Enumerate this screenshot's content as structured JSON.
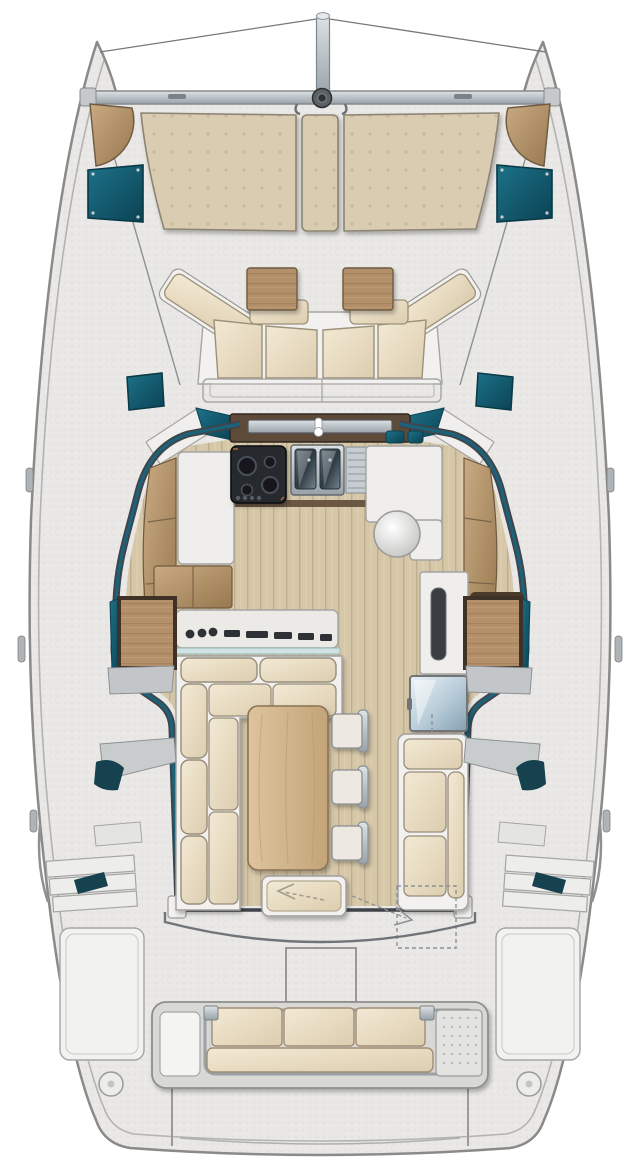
{
  "image": {
    "kind": "catamaran-deck-and-saloon-floor-plan",
    "view": "top-down",
    "visible_text": "none"
  },
  "palette": {
    "page_bg": "#ffffff",
    "deck_base": "#e9e8e6",
    "hull_outline": "#8a8a88",
    "gunwale_line": "#b3b3b1",
    "white_panel": "#f2f1ef",
    "panel_line": "#a5a5a3",
    "teal_glass": "#19647c",
    "teal_dark": "#0c4253",
    "wall_dark": "#40454b",
    "wood_mid": "#b08e66",
    "wood_frame": "#4a3a2a",
    "plank_base": "#d6c7a9",
    "table_wood": "#d2b68c",
    "cushion_cream": "#ecdfc6",
    "cushion_line": "#9c9179",
    "sunpad_beige": "#d9ccb1",
    "stove_black": "#26292e",
    "steel": "#aeb9c0",
    "fridge_steel": "#a9bfcd",
    "fitting_gray": "#b4b7ba",
    "dash_gray": "#8e9296",
    "glass_ledge": "#cfe3e2"
  },
  "components": {
    "rigging": [
      "bowsprit-pole",
      "forestay-wires",
      "forward-crossbeam",
      "beam-center-fitting"
    ],
    "foredeck": [
      "bow-step-pad-port",
      "bow-step-pad-starboard",
      "trampoline-port",
      "trampoline-starboard",
      "sunpad-port",
      "sunpad-center",
      "sunpad-starboard",
      "deck-plate-port",
      "deck-plate-starboard"
    ],
    "forward_cockpit": [
      "lounge-backrest-port",
      "lounge-backrest-starboard",
      "seat-cushions",
      "cocktail-table-port",
      "cocktail-table-starboard",
      "step-locker"
    ],
    "galley": [
      "sliding-window-track",
      "faucet",
      "stove-two-burner",
      "double-sink",
      "drainboard",
      "counter-port",
      "counter-starboard",
      "round-basin",
      "teal-canisters",
      "tall-cabinet-with-slot",
      "framed-locker",
      "shelf-bands"
    ],
    "nav_station": [
      "chart-desk",
      "instrument-knobs",
      "instrument-slots",
      "glass-ledge"
    ],
    "saloon": [
      "l-shaped-sofa",
      "dining-table",
      "chair-1",
      "chair-2",
      "chair-3",
      "footstool-with-arrow",
      "refrigerator",
      "chaise-bench",
      "door-swing-dashed-path"
    ],
    "side_decks": [
      "hull-companionway-port",
      "hull-companionway-starboard",
      "moulded-steps",
      "boarding-steps-port",
      "boarding-steps-starboard",
      "hull-window-slivers",
      "handrails"
    ],
    "aft": [
      "aft-bulkhead",
      "cockpit-coaming-curve",
      "engine-hatch",
      "quarter-panel-port",
      "quarter-panel-starboard",
      "aft-bench-three-seats",
      "liferaft-grid-panel",
      "deck-hatch-port",
      "deck-hatch-starboard",
      "transom-steps"
    ]
  }
}
